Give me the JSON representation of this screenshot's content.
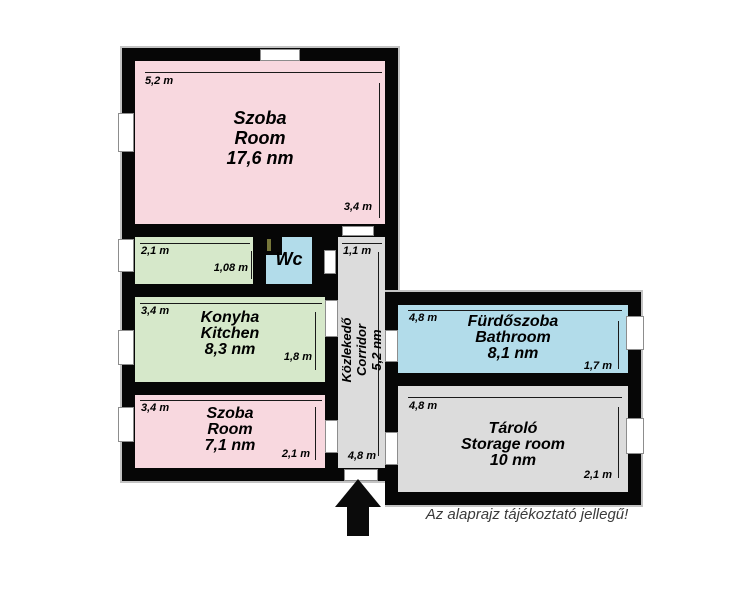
{
  "footer": {
    "disclaimer": "Az alaprajz tájékoztató jellegű!"
  },
  "colors": {
    "wall": "#060606",
    "outline": "#c3c3c3",
    "room_pink": "#f8d8df",
    "room_green": "#d6e8ca",
    "room_blue": "#b2dcea",
    "room_gray": "#dcdcdc",
    "arrow_black": "#0b0b0b"
  },
  "rooms": [
    {
      "id": "room-large",
      "name_hu": "Szoba",
      "name_en": "Room",
      "area": "17,6 nm",
      "dim_top": "5,2 m",
      "dim_side": "3,4 m"
    },
    {
      "id": "pantry",
      "name_hu": "",
      "name_en": "",
      "area": "",
      "dim_top": "2,1 m",
      "dim_side": "1,08 m"
    },
    {
      "id": "wc",
      "name_hu": "Wc",
      "name_en": "",
      "area": ""
    },
    {
      "id": "kitchen",
      "name_hu": "Konyha",
      "name_en": "Kitchen",
      "area": "8,3 nm",
      "dim_top": "3,4 m",
      "dim_side": "1,8 m"
    },
    {
      "id": "room-small",
      "name_hu": "Szoba",
      "name_en": "Room",
      "area": "7,1 nm",
      "dim_top": "3,4 m",
      "dim_side": "2,1 m"
    },
    {
      "id": "corridor",
      "name_hu": "Közlekedő",
      "name_en": "Corridor",
      "area": "5,2 nm",
      "dim_top": "1,1 m",
      "dim_side": "4,8 m"
    },
    {
      "id": "bathroom",
      "name_hu": "Fürdőszoba",
      "name_en": "Bathroom",
      "area": "8,1 nm",
      "dim_top": "4,8 m",
      "dim_side": "1,7 m"
    },
    {
      "id": "storage",
      "name_hu": "Tároló",
      "name_en": "Storage room",
      "area": "10 nm",
      "dim_top": "4,8 m",
      "dim_side": "2,1 m"
    }
  ]
}
